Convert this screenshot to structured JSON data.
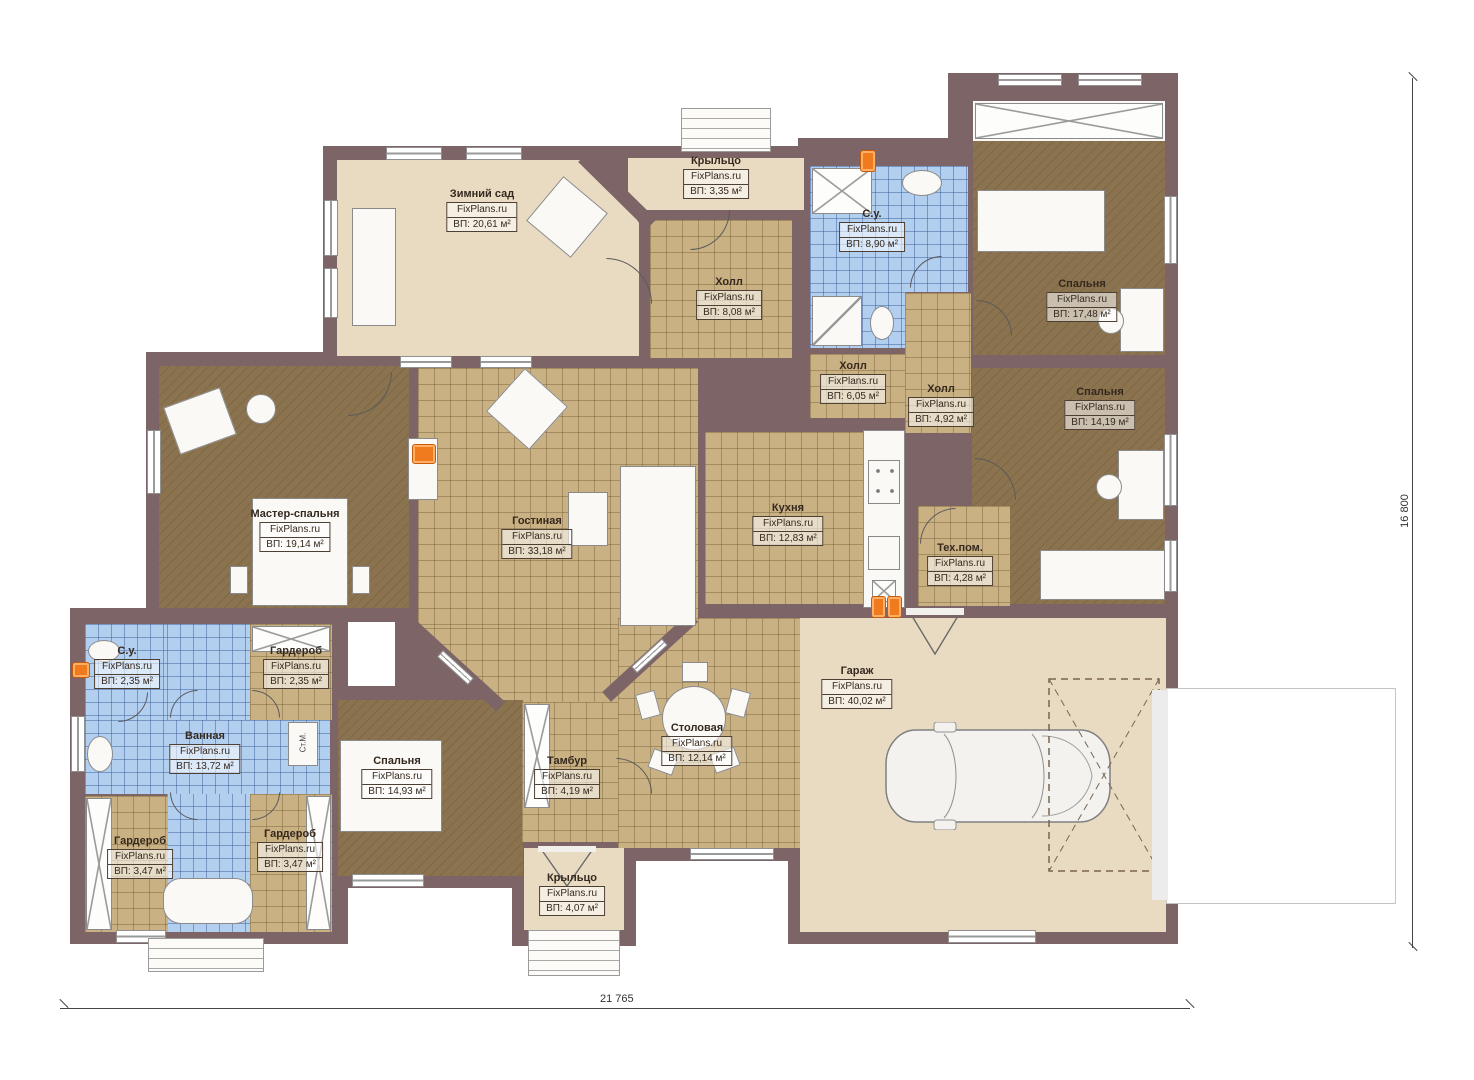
{
  "watermark": "FixPlans.ru",
  "dimensions": {
    "width_label": "21 765",
    "height_label": "16 800"
  },
  "labels": {
    "washer": "Ст.М."
  },
  "rooms": [
    {
      "id": "winter-garden",
      "name": "Зимний сад",
      "area": "ВП: 20,61 м²"
    },
    {
      "id": "porch-top",
      "name": "Крыльцо",
      "area": "ВП: 3,35 м²"
    },
    {
      "id": "hall-top",
      "name": "Холл",
      "area": "ВП: 8,08 м²"
    },
    {
      "id": "bathroom-top",
      "name": "С.у.",
      "area": "ВП: 8,90 м²"
    },
    {
      "id": "bedroom-top-right",
      "name": "Спальня",
      "area": "ВП: 17,48 м²"
    },
    {
      "id": "hall-mid",
      "name": "Холл",
      "area": "ВП: 6,05 м²"
    },
    {
      "id": "hall-small",
      "name": "Холл",
      "area": "ВП: 4,92 м²"
    },
    {
      "id": "bedroom-right",
      "name": "Спальня",
      "area": "ВП: 14,19 м²"
    },
    {
      "id": "master-bedroom",
      "name": "Мастер-спальня",
      "area": "ВП: 19,14 м²"
    },
    {
      "id": "living-room",
      "name": "Гостиная",
      "area": "ВП: 33,18 м²"
    },
    {
      "id": "kitchen",
      "name": "Кухня",
      "area": "ВП: 12,83 м²"
    },
    {
      "id": "tech-room",
      "name": "Тех.пом.",
      "area": "ВП: 4,28 м²"
    },
    {
      "id": "wc-left",
      "name": "С.у.",
      "area": "ВП: 2,35 м²"
    },
    {
      "id": "wardrobe-top",
      "name": "Гардероб",
      "area": "ВП: 2,35 м²"
    },
    {
      "id": "bathroom-main",
      "name": "Ванная",
      "area": "ВП: 13,72 м²"
    },
    {
      "id": "bedroom-bottom",
      "name": "Спальня",
      "area": "ВП: 14,93 м²"
    },
    {
      "id": "vestibule",
      "name": "Тамбур",
      "area": "ВП: 4,19 м²"
    },
    {
      "id": "dining-room",
      "name": "Столовая",
      "area": "ВП: 12,14 м²"
    },
    {
      "id": "garage",
      "name": "Гараж",
      "area": "ВП: 40,02 м²"
    },
    {
      "id": "wardrobe-bottom-left",
      "name": "Гардероб",
      "area": "ВП: 3,47 м²"
    },
    {
      "id": "wardrobe-bottom-right",
      "name": "Гардероб",
      "area": "ВП: 3,47 м²"
    },
    {
      "id": "porch-bottom",
      "name": "Крыльцо",
      "area": "ВП: 4,07 м²"
    }
  ],
  "colors": {
    "wall": "#7c6467",
    "floor_beige": "#e9dbc2",
    "floor_tile": "#c9b183",
    "floor_carpet": "#8a734e",
    "floor_wet": "#b2cff0",
    "heater": "#f07a1e"
  }
}
